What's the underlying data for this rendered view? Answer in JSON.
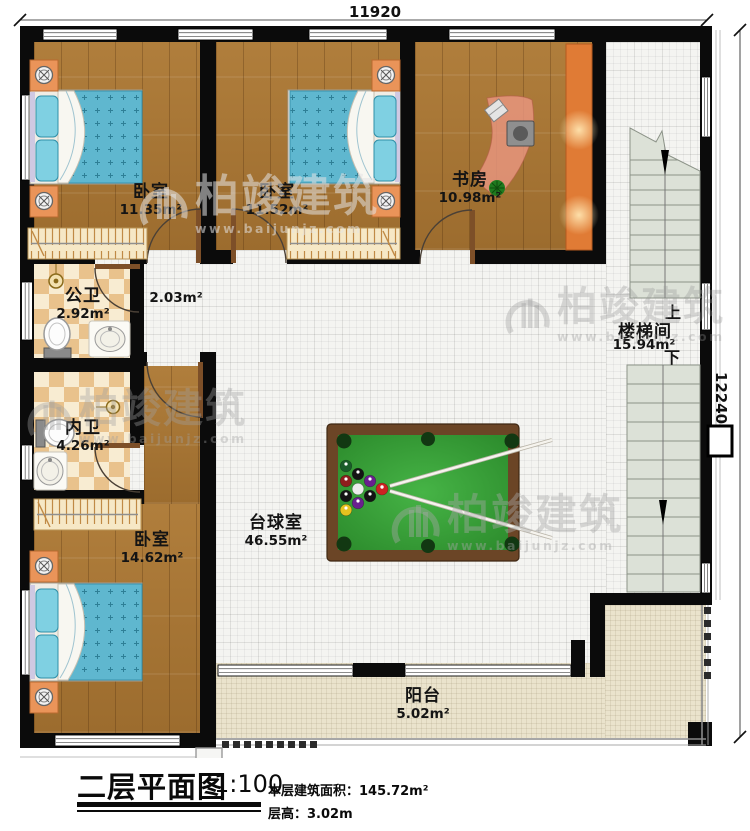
{
  "dimensions": {
    "top": "11920",
    "right": "12240"
  },
  "rooms": {
    "bedroom_top_left": {
      "name": "卧室",
      "area": "11.35m²"
    },
    "bedroom_top_mid": {
      "name": "卧室",
      "area": "11.52m²"
    },
    "study": {
      "name": "书房",
      "area": "10.98m²"
    },
    "hallway": {
      "area": "2.03m²"
    },
    "public_bathroom": {
      "name": "公卫",
      "area": "2.92m²"
    },
    "inner_bathroom": {
      "name": "内卫",
      "area": "4.26m²"
    },
    "bedroom_bottom_left": {
      "name": "卧室",
      "area": "14.62m²"
    },
    "billiard_room": {
      "name": "台球室",
      "area": "46.55m²"
    },
    "stairwell": {
      "name": "楼梯间",
      "area": "15.94m²",
      "up": "上",
      "down": "下"
    },
    "balcony": {
      "name": "阳台",
      "area": "5.02m²"
    }
  },
  "title_block": {
    "title": "二层平面图",
    "scale": "1:100",
    "floor_area": "本层建筑面积：145.72m²",
    "floor_height": "层高：3.02m"
  },
  "watermark": {
    "brand": "柏竣建筑",
    "site": "www.baijunjz.com"
  },
  "colors": {
    "wall": "#0b0b0b",
    "wood_floor": "#a87a38",
    "tile_floor": "#f4f4f1",
    "checker_tile": "#e9c28c",
    "balcony_floor": "#eae3cc",
    "pool_felt": "#3aa838",
    "table_rim": "#6b4526",
    "cabinet_orange": "#e07b35",
    "bed_blue": "#5fb7cf"
  }
}
